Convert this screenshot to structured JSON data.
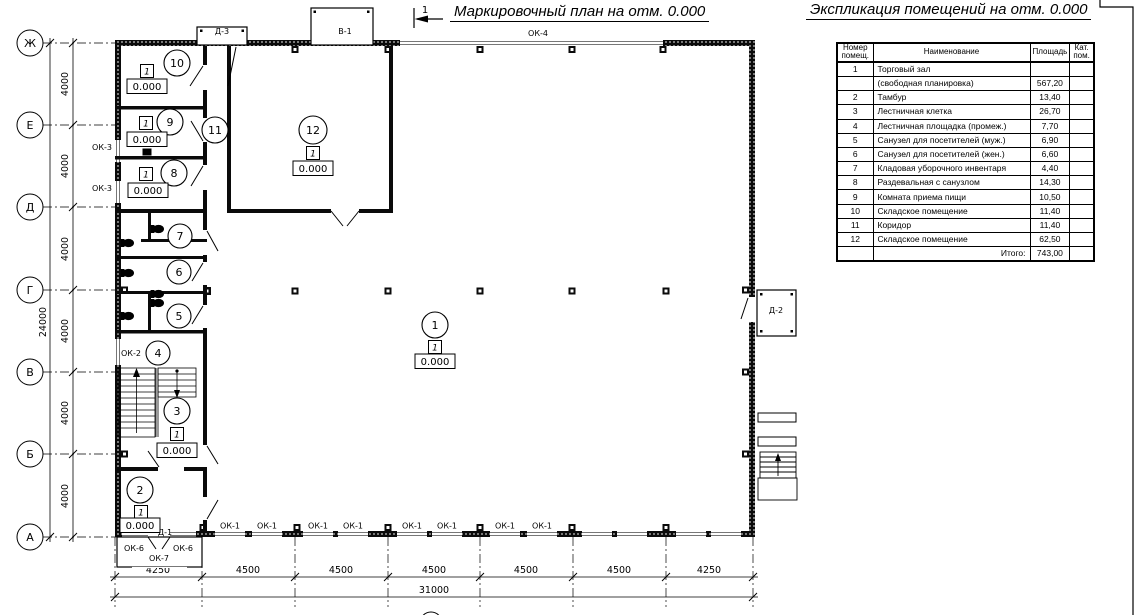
{
  "titles": {
    "plan": "Маркировочный план на отм. 0.000",
    "explication": "Экспликация помещений на отм. 0.000"
  },
  "section_marker": "1",
  "table": {
    "headers": {
      "num": "Номер\nпомещ.",
      "name": "Наименование",
      "area": "Площадь",
      "cat": "Кат.\nпом."
    },
    "rows": [
      {
        "n": "1",
        "name": "Торговый зал",
        "a": ""
      },
      {
        "n": "",
        "name": "(свободная планировка)",
        "a": "567,20"
      },
      {
        "n": "2",
        "name": "Тамбур",
        "a": "13,40"
      },
      {
        "n": "3",
        "name": "Лестничная клетка",
        "a": "26,70"
      },
      {
        "n": "4",
        "name": "Лестничная площадка (промеж.)",
        "a": "7,70"
      },
      {
        "n": "5",
        "name": "Санузел для посетителей (муж.)",
        "a": "6,90"
      },
      {
        "n": "6",
        "name": "Санузел для посетителей (жен.)",
        "a": "6,60"
      },
      {
        "n": "7",
        "name": "Кладовая уборочного инвентаря",
        "a": "4,40"
      },
      {
        "n": "8",
        "name": "Раздевальная с санузлом",
        "a": "14,30"
      },
      {
        "n": "9",
        "name": "Комната приема пищи",
        "a": "10,50"
      },
      {
        "n": "10",
        "name": "Складское помещение",
        "a": "11,40"
      },
      {
        "n": "11",
        "name": "Коридор",
        "a": "11,40"
      },
      {
        "n": "12",
        "name": "Складское помещение",
        "a": "62,50"
      },
      {
        "n": "",
        "name": "Итого:",
        "a": "743,00"
      }
    ]
  },
  "axes": {
    "rows": [
      "Ж",
      "Е",
      "Д",
      "Г",
      "В",
      "Б",
      "А"
    ]
  },
  "dims": {
    "v4000": "4000",
    "v24000": "24000",
    "d4250": "4250",
    "d4500": "4500",
    "d31000": "31000"
  },
  "openings": {
    "ok1": "ОК-1",
    "ok2": "ОК-2",
    "ok3": "ОК-3",
    "ok4": "ОК-4",
    "ok6": "ОК-6",
    "ok7": "ОК-7",
    "d1": "Д-1",
    "d2": "Д-2",
    "d3": "Д-3",
    "v1": "В-1"
  },
  "rooms": {
    "r1": {
      "num": "1",
      "floor": "1",
      "elev": "0.000"
    },
    "r2": {
      "num": "2",
      "floor": "1",
      "elev": "0.000"
    },
    "r3": {
      "num": "3",
      "floor": "1",
      "elev": "0.000"
    },
    "r4": {
      "num": "4"
    },
    "r5": {
      "num": "5"
    },
    "r6": {
      "num": "6"
    },
    "r7": {
      "num": "7"
    },
    "r8": {
      "num": "8",
      "floor": "1",
      "elev": "0.000"
    },
    "r9": {
      "num": "9",
      "floor": "1",
      "elev": "0.000"
    },
    "r10": {
      "num": "10",
      "floor": "1",
      "elev": "0.000"
    },
    "r11": {
      "num": "11"
    },
    "r12": {
      "num": "12",
      "floor": "1",
      "elev": "0.000"
    }
  }
}
